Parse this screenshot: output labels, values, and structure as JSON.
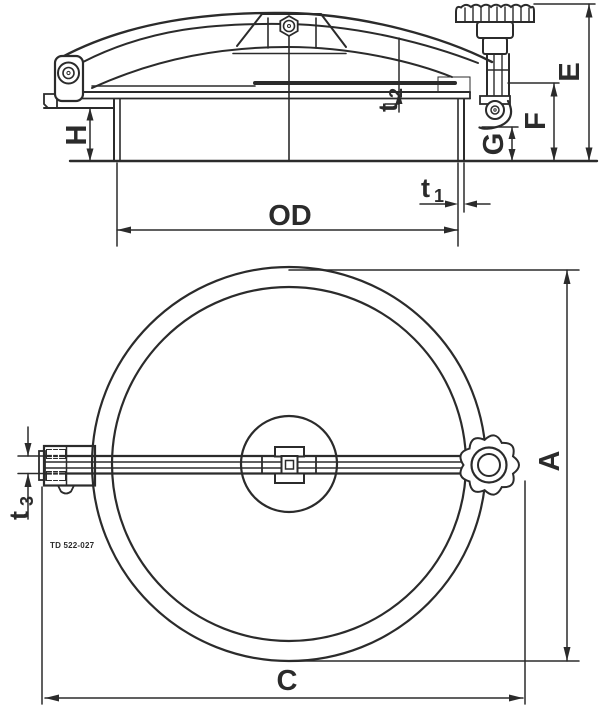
{
  "drawing": {
    "type": "technical-drawing",
    "subject": "round tank manway lid, side section and plan view",
    "colors": {
      "ink": "#2b2b2b",
      "background": "#ffffff"
    },
    "side_view": {
      "labels": {
        "E": "E",
        "F": "F",
        "G": "G",
        "H": "H",
        "OD": "OD",
        "t1_base": "t",
        "t1_sub": "1",
        "t2_base": "t",
        "t2_sub": "2"
      }
    },
    "plan_view": {
      "labels": {
        "A": "A",
        "C": "C",
        "t3_base": "t",
        "t3_sub": "3"
      },
      "part_note": "TD 522-027"
    }
  }
}
